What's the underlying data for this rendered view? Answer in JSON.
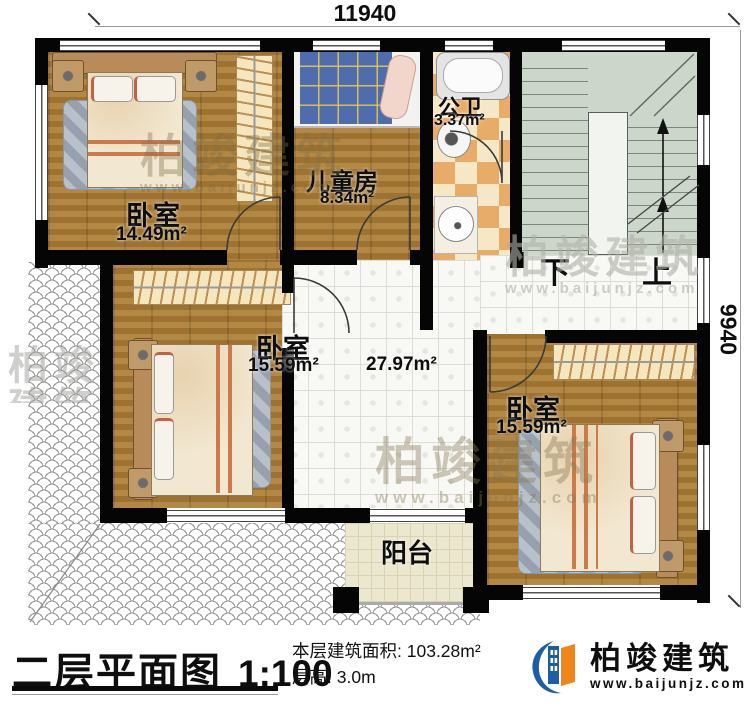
{
  "dimensions": {
    "width_top": "11940",
    "height_right": "9940"
  },
  "rooms": {
    "bedroom_top_left": {
      "name": "卧室",
      "area": "14.49m²"
    },
    "kids_room": {
      "name": "儿童房",
      "area": "8.34m²"
    },
    "bathroom": {
      "name": "公卫",
      "area": "3.37m²"
    },
    "bedroom_mid_left": {
      "name": "卧室",
      "area": "15.59m²"
    },
    "bedroom_bottom_right": {
      "name": "卧室",
      "area": "15.59m²"
    },
    "hall": {
      "area": "27.97m²"
    },
    "balcony": {
      "name": "阳台"
    },
    "stairs": {
      "down": "下",
      "up": "上"
    }
  },
  "title_block": {
    "title": "二层平面图",
    "scale": "1:100",
    "area_label": "本层建筑面积:",
    "area_value": "103.28m²",
    "floor_height_label": "层高:",
    "floor_height_value": "3.0m"
  },
  "brand": {
    "name": "柏竣建筑",
    "url": "www.baijunjz.com",
    "blue": "#1b5ea6",
    "orange": "#f08519"
  }
}
